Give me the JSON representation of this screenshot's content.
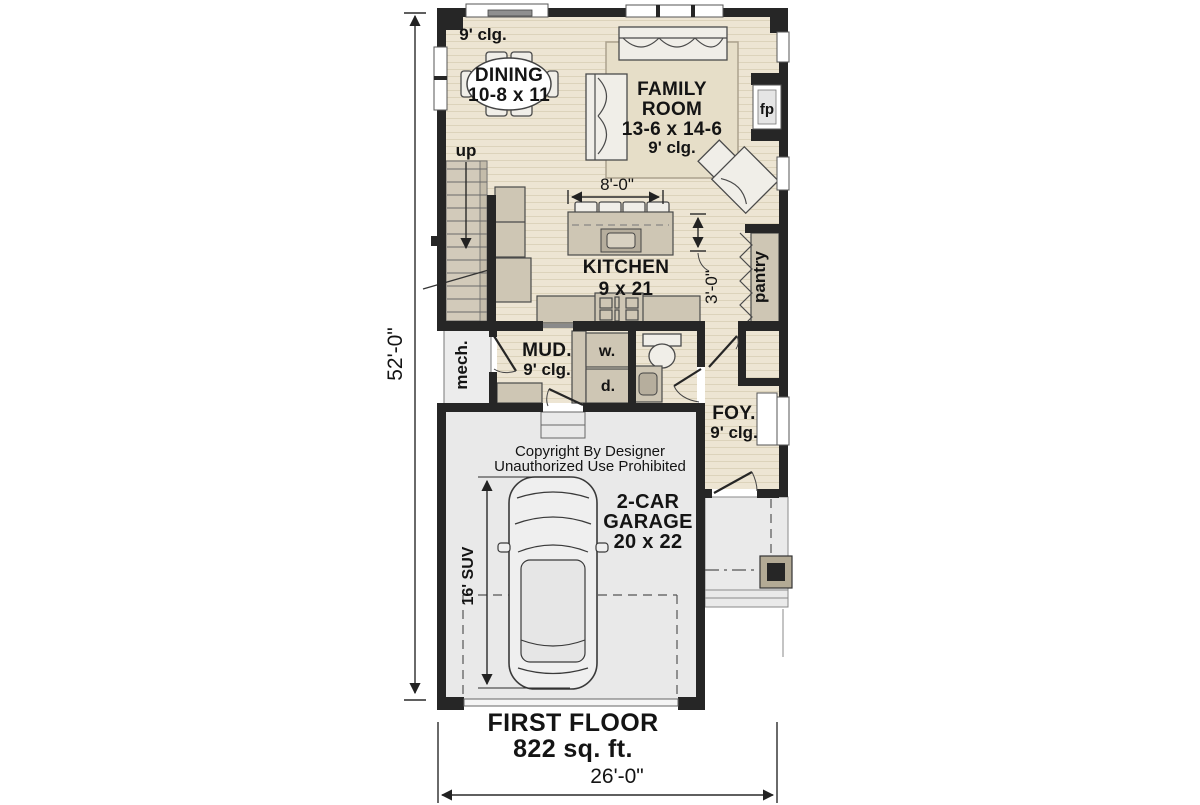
{
  "plan": {
    "title": {
      "name": "FIRST FLOOR",
      "area": "822 sq. ft."
    },
    "copyright": {
      "line1": "Copyright By Designer",
      "line2": "Unauthorized Use Prohibited"
    },
    "dimensions": {
      "overall_depth": "52'-0\"",
      "overall_width": "26'-0\"",
      "kitchen_clearance": "8'-0\"",
      "pantry_walkway": "3'-0\"",
      "suv_length": "16' SUV"
    },
    "rooms": {
      "dining": {
        "name": "DINING",
        "size": "10-8 x 11",
        "ceiling": "9' clg."
      },
      "family": {
        "line1": "FAMILY",
        "line2": "ROOM",
        "size": "13-6 x 14-6",
        "ceiling": "9' clg."
      },
      "kitchen": {
        "name": "KITCHEN",
        "size": "9 x 21"
      },
      "mud": {
        "name": "MUD.",
        "ceiling": "9' clg."
      },
      "foyer": {
        "name": "FOY.",
        "ceiling": "9' clg."
      },
      "garage": {
        "line1": "2-CAR",
        "line2": "GARAGE",
        "size": "20 x 22"
      },
      "pantry": {
        "name": "pantry"
      },
      "mech": {
        "name": "mech."
      }
    },
    "labels": {
      "fireplace": "fp",
      "stairs_up": "up",
      "washer": "w.",
      "dryer": "d."
    },
    "colors": {
      "wall": "#262626",
      "wood_floor": "#EDE5D3",
      "wood_stripe": "#DCD3BB",
      "cabinet": "#CEC6B4",
      "garage_floor": "#E9E9E9",
      "rug": "#E6DEC8",
      "furniture": "#F0EEE8",
      "porch_post": "#B3AA95"
    }
  }
}
